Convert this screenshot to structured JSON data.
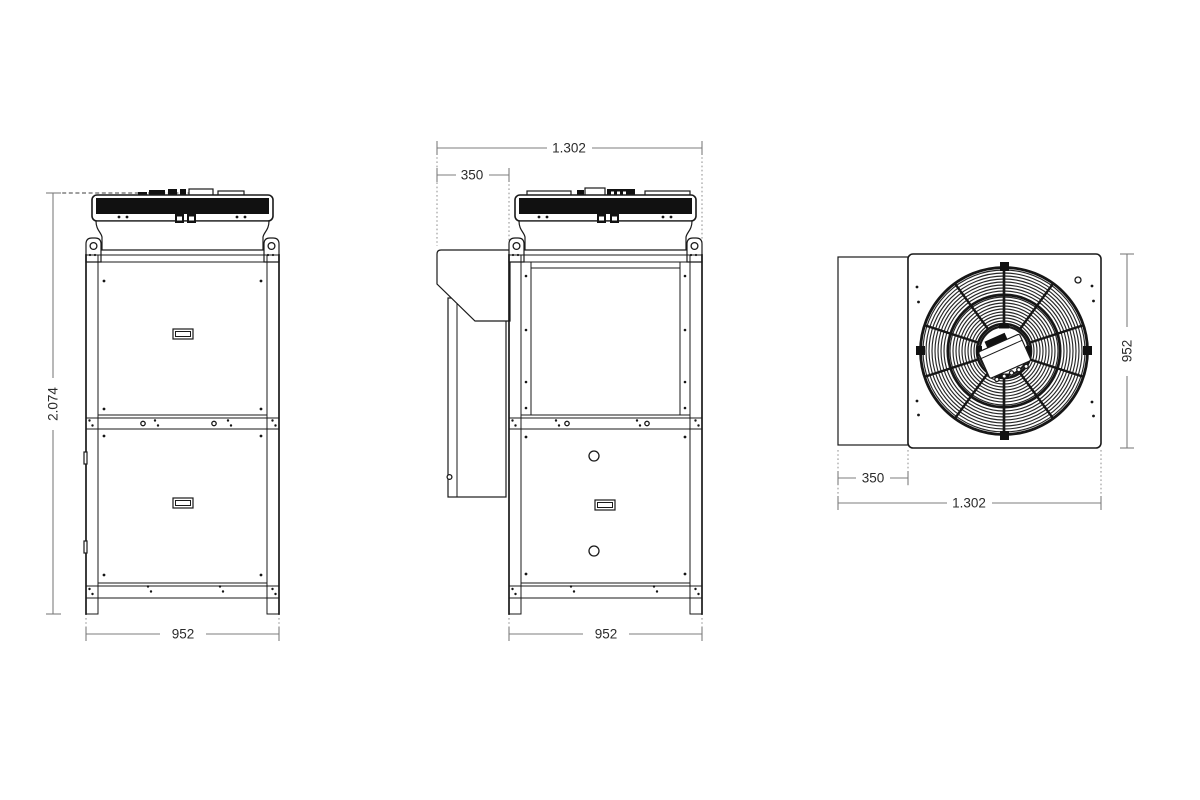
{
  "style": {
    "background": "#ffffff",
    "line_color": "#1a1a1a",
    "dim_line_color": "#7d7d7d",
    "dim_text_color": "#2b2b2b"
  },
  "dimensions": {
    "front": {
      "height": "2.074",
      "width": "952"
    },
    "side": {
      "total_depth": "1.302",
      "hood_depth": "350",
      "width": "952"
    },
    "top": {
      "width": "952",
      "hood_depth": "350",
      "total_depth": "1.302"
    }
  }
}
